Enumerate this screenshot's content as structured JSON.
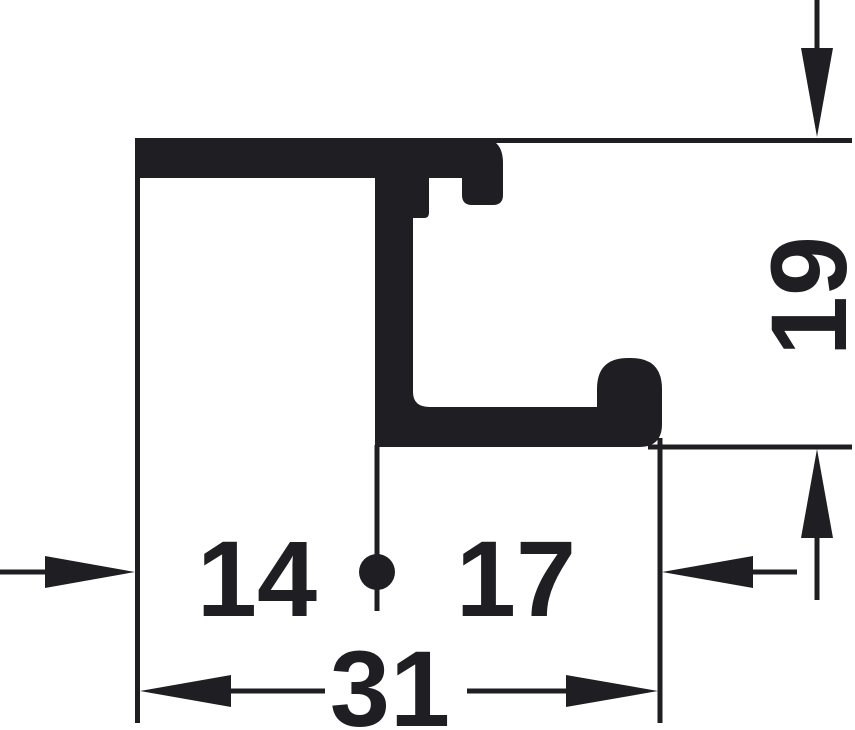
{
  "diagram": {
    "kind": "profile-cross-section-dimension-drawing",
    "dimensions": {
      "depth": "19",
      "left_segment": "14",
      "right_segment": "17",
      "overall_width": "31"
    }
  },
  "colors": {
    "ink": "#1f1f23",
    "background": "#ffffff"
  }
}
